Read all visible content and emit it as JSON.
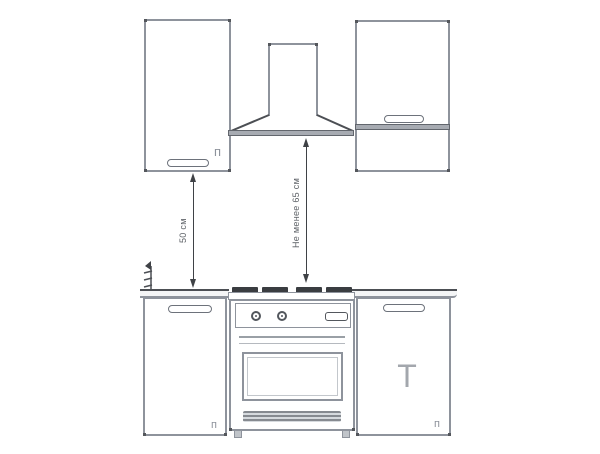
{
  "diagram": {
    "type": "kitchen-hood-installation-clearance-diagram",
    "colors": {
      "background": "#ffffff",
      "outline": "#8e939c",
      "dark_line": "#3f4246",
      "label_text": "#5f6368",
      "grate_fill": "#3a3d41"
    },
    "labels": {
      "cabinet_to_counter": "50 см",
      "hood_to_stove": "Не менее 65 см"
    },
    "marks": {
      "left_wall_cabinet": "п",
      "left_base_cabinet": "п",
      "right_base_cabinet": "п",
      "right_base_tee": "T"
    }
  }
}
